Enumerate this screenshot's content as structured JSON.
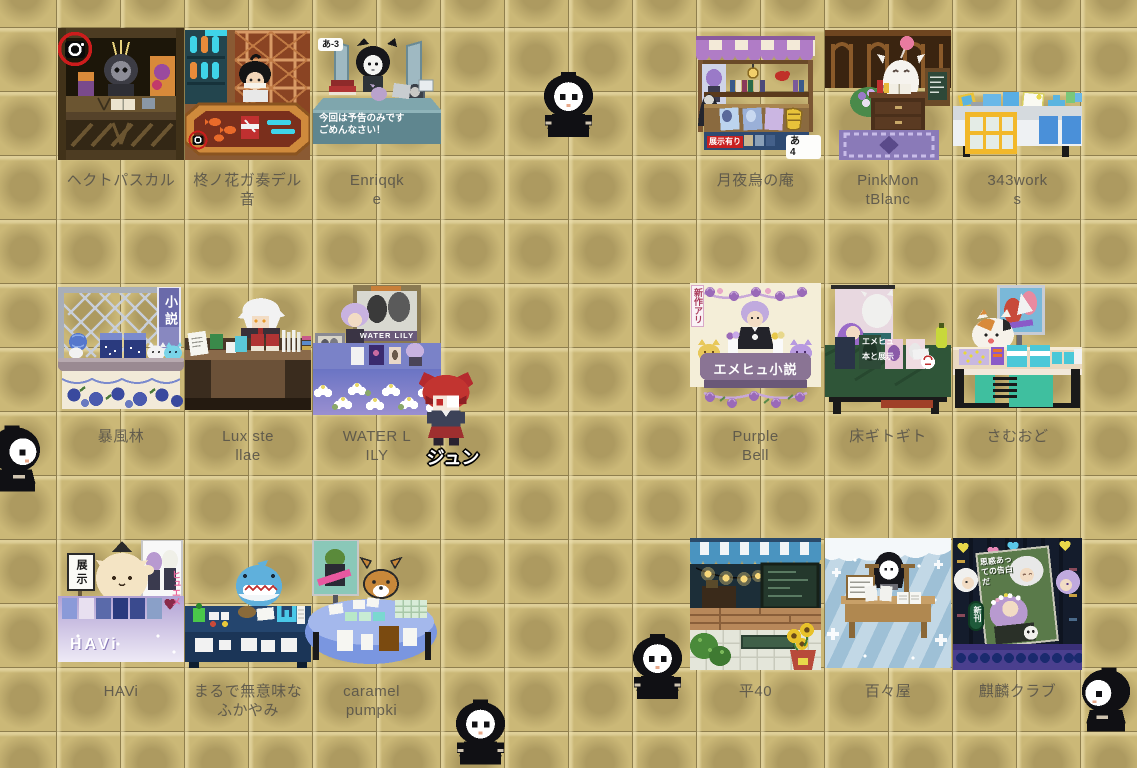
{
  "booths": [
    {
      "id": "hectopascal",
      "label": "ヘクトパスカル"
    },
    {
      "id": "hiiragi-no-hana",
      "label": "柊ノ花ガ奏デル\n音"
    },
    {
      "id": "enriqqke",
      "label": "Enriqqk\ne",
      "slot_tag": "あ-3",
      "notice": "今回は予告のみです\nごめんなさい！"
    },
    {
      "id": "tsukiyodori-no-iori",
      "label": "月夜烏の庵",
      "notice_tag": "展示有り",
      "slot_tag": "あ 4"
    },
    {
      "id": "pinkmontblanc",
      "label": "PinkMon\ntBlanc"
    },
    {
      "id": "343works",
      "label": "343work\ns"
    },
    {
      "id": "boufuurin",
      "label": "暴風林",
      "banner": "小説"
    },
    {
      "id": "lux-stellae",
      "label": "Lux ste\nllae"
    },
    {
      "id": "water-lily",
      "label": "WATER L\nILY",
      "poster_caption": "WATER LILY"
    },
    {
      "id": "purple-bell",
      "label": "Purple\nBell",
      "banner": "新作アリ",
      "table_text": "エメヒュ小説"
    },
    {
      "id": "yuka-gitogito",
      "label": "床ギトギト",
      "poster_text": "エメヒュ\n本と展示"
    },
    {
      "id": "samuodo",
      "label": "さむおど"
    },
    {
      "id": "havi",
      "label": "HAVi",
      "sign_text": "展示",
      "poster_text": "ヒュエメ",
      "table_text": "HAVi"
    },
    {
      "id": "marude-muimina-fukayami",
      "label": "まるで無意味な\nふかやみ"
    },
    {
      "id": "caramel-pumpki",
      "label": "caramel\npumpki"
    },
    {
      "id": "hira40",
      "label": "平40"
    },
    {
      "id": "momoya",
      "label": "百々屋"
    },
    {
      "id": "kirin-club",
      "label": "麒麟クラブ",
      "new_release_tag": "新刊",
      "cover_text": "思惑あっての告白だ"
    }
  ],
  "characters": {
    "jun": {
      "name": "ジュン"
    }
  }
}
